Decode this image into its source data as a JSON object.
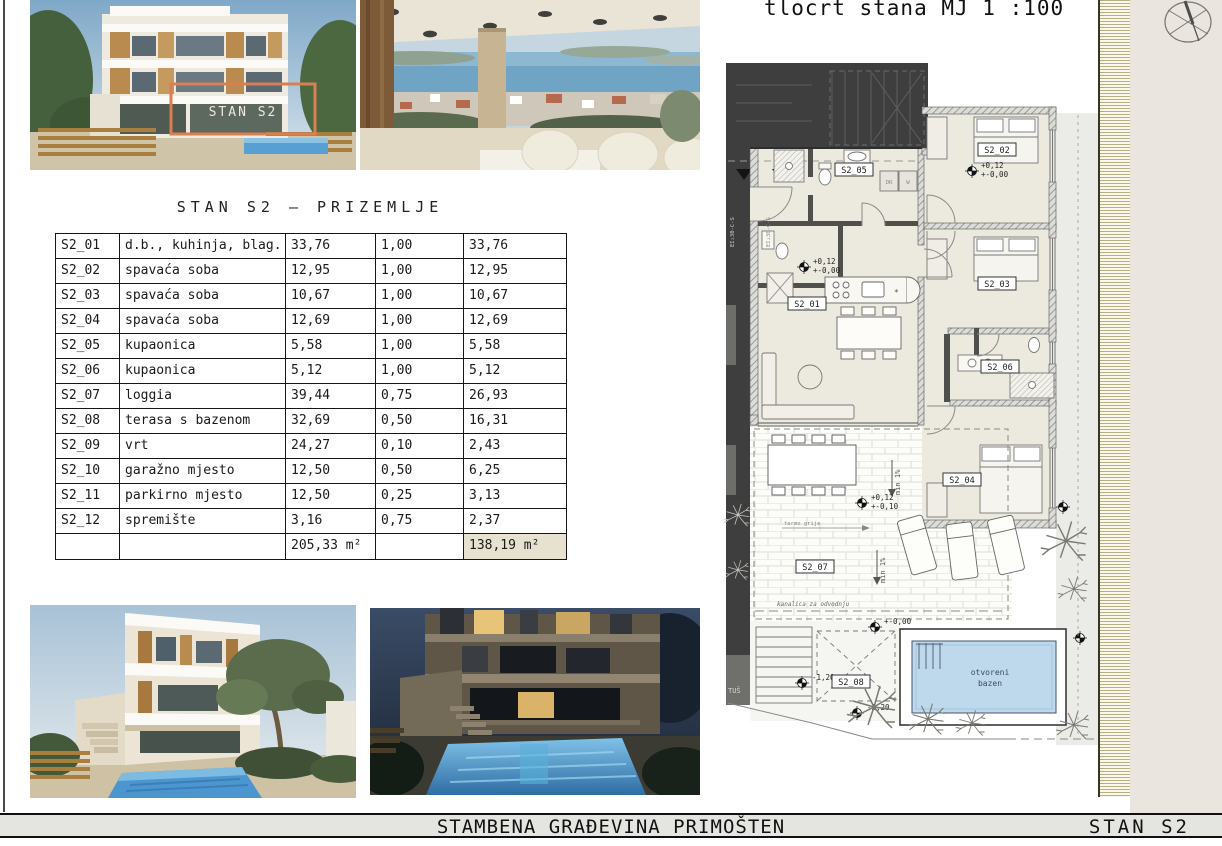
{
  "title_block": {
    "project": "STAMBENA GRAĐEVINA PRIMOŠTEN",
    "sheet": "STAN S2"
  },
  "renders": {
    "overlay_label": "STAN S2"
  },
  "table": {
    "title": "STAN S2 – PRIZEMLJE",
    "rows": [
      {
        "id": "S2_01",
        "name": "d.b., kuhinja, blag.",
        "area": "33,76",
        "coef": "1,00",
        "value": "33,76"
      },
      {
        "id": "S2_02",
        "name": "spavaća soba",
        "area": "12,95",
        "coef": "1,00",
        "value": "12,95"
      },
      {
        "id": "S2_03",
        "name": "spavaća soba",
        "area": "10,67",
        "coef": "1,00",
        "value": "10,67"
      },
      {
        "id": "S2_04",
        "name": "spavaća soba",
        "area": "12,69",
        "coef": "1,00",
        "value": "12,69"
      },
      {
        "id": "S2_05",
        "name": "kupaonica",
        "area": "5,58",
        "coef": "1,00",
        "value": "5,58"
      },
      {
        "id": "S2_06",
        "name": "kupaonica",
        "area": "5,12",
        "coef": "1,00",
        "value": "5,12"
      },
      {
        "id": "S2_07",
        "name": "loggia",
        "area": "39,44",
        "coef": "0,75",
        "value": "26,93"
      },
      {
        "id": "S2_08",
        "name": "terasa s bazenom",
        "area": "32,69",
        "coef": "0,50",
        "value": "16,31"
      },
      {
        "id": "S2_09",
        "name": "vrt",
        "area": "24,27",
        "coef": "0,10",
        "value": "2,43"
      },
      {
        "id": "S2_10",
        "name": "garažno mjesto",
        "area": "12,50",
        "coef": "0,50",
        "value": "6,25"
      },
      {
        "id": "S2_11",
        "name": "parkirno mjesto",
        "area": "12,50",
        "coef": "0,25",
        "value": "3,13"
      },
      {
        "id": "S2_12",
        "name": "spremište",
        "area": "3,16",
        "coef": "0,75",
        "value": "2,37"
      }
    ],
    "total_area": "205,33 m²",
    "total_value": "138,19 m²"
  },
  "plan": {
    "title": "tlocrt stana MJ 1 :100",
    "room_labels": {
      "s2_01": "S2_01",
      "s2_02": "S2_02",
      "s2_03": "S2_03",
      "s2_04": "S2_04",
      "s2_05": "S2_05",
      "s2_06": "S2_06",
      "s2_07": "S2_07",
      "s2_08": "S2_08"
    },
    "stair_label": "S2",
    "closets": {
      "dr": "DR",
      "w": "W"
    },
    "shower": "TUŠ",
    "fire_rating": "EI₂30-C-S",
    "pool": {
      "line1": "otvoreni",
      "line2": "bazen"
    },
    "drain_note": "kanalica za odvodnju",
    "thermal_note": "termo grije",
    "slope_note": "min 1%",
    "levels": {
      "bedroom_upper": "+0,12",
      "bedroom_lower": "+-0,00",
      "living_upper": "+0,12",
      "living_lower": "+-0,00",
      "terrace_upper": "+0,12",
      "terrace_lower": "+-0,10",
      "deck": "+-0,00",
      "stairs": "-1,20",
      "garden": "-2,20"
    }
  },
  "colors": {
    "accent_orange": "#d97f52",
    "pool_blue": "#bed8ec",
    "room_beige": "#ece9df",
    "dark_mass": "#3e3e3e",
    "hatch_olive": "#b5ae7e"
  }
}
